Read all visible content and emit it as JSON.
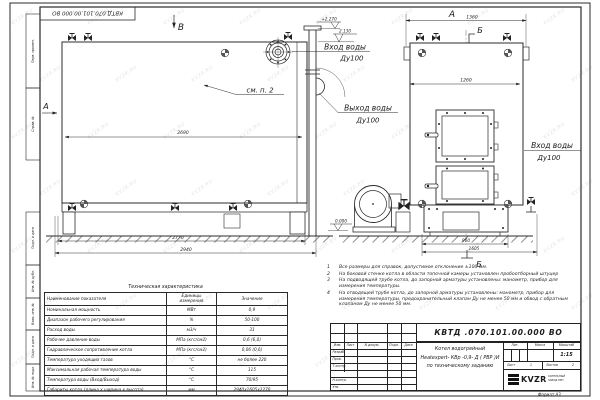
{
  "meta": {
    "corner_number": "КВТД.070.101.00.000 ВО",
    "format": "Формат  А3",
    "watermark": "KVZR.RU"
  },
  "view_labels": {
    "v_b": "В",
    "v_a_left": "А",
    "v_a_top": "А",
    "sec_b_top": "Б",
    "sec_b_bottom": "Б"
  },
  "dims": {
    "d1360": "1360",
    "d1260": "1260",
    "d2690": "2690",
    "d2770": "2770",
    "d2940": "2940",
    "d960": "960",
    "d1605": "1605"
  },
  "elev": {
    "top": "+2.270",
    "mid": "2.130",
    "zero": "0.000"
  },
  "labels": {
    "see_note": "см. п. 2",
    "inlet_top_line1": "Вход воды",
    "inlet_top_line2": "Ду100",
    "outlet_line1": "Выход воды",
    "outlet_line2": "Ду100",
    "inlet_right_line1": "Вход воды",
    "inlet_right_line2": "Ду100"
  },
  "margin_stamps": [
    "Перв. примен.",
    "Справ. №",
    "Подп. и дата",
    "Инв. № дубл.",
    "Взам. инв. №",
    "Подп. и дата",
    "Инв. № подл."
  ],
  "tech_table": {
    "title": "Техническая характеристика",
    "headers": [
      "Наименование показателя",
      "Единицы измерения",
      "Значение"
    ],
    "rows": [
      [
        "Номинальная мощность",
        "МВт",
        "0,9"
      ],
      [
        "Диапазон рабочего регулирования",
        "%",
        "50-100"
      ],
      [
        "Расход воды",
        "м3/ч",
        "31"
      ],
      [
        "Рабочее давление воды",
        "МПа (кгс/см2)",
        "0,6 (6,0)"
      ],
      [
        "Гидравлическое сопротивление котла",
        "МПа (кгс/см2)",
        "0,06 (0,6)"
      ],
      [
        "Температура уходящих газов",
        "°С",
        "не более 220"
      ],
      [
        "Максимальная рабочая температура воды",
        "°С",
        "115"
      ],
      [
        "Температура воды (Вход/Выход)",
        "°С",
        "70/95"
      ],
      [
        "Габариты котла (длина х ширина х высота)",
        "мм",
        "2940х1605х2270"
      ]
    ]
  },
  "notes": [
    {
      "num": "1",
      "text": "Все размеры для справок, допустимое отклонение ±100 мм."
    },
    {
      "num": "2",
      "text": "На боковой стенке котла в области топочной камеры установлен пробоотборный штуцер"
    },
    {
      "num": "3",
      "text": "На подводящей трубе котла, до запорной арматуры установлены: манометр, прибор для измерения температуры."
    },
    {
      "num": "4",
      "text": "На отводящей трубе котла, до запорной арматуры установлены: манометр, прибор для измерения температуры, предохранительный клапан Ду не менее 50 мм и обвод с обратным клапаном Ду не менее 50 мм."
    }
  ],
  "title_block": {
    "doc_number": "КВТД .070.101.00.000  ВО",
    "header_cells": [
      "Изм.",
      "Лист",
      "N докум.",
      "Подп.",
      "Дата"
    ],
    "roles": [
      "Разраб.",
      "Пров.",
      "Т.контр.",
      "Н.контр.",
      "Утв."
    ],
    "product_lines": [
      "Котел водогрейный",
      "Heatexpert- КВр -0,9- Д ( РВР )И",
      "по техническому заданию"
    ],
    "lit_label": "Лит.",
    "mass_label": "Масса",
    "scale_label": "Масштаб",
    "scale_value": "1:15",
    "sheet_label": "Лист",
    "sheet_value": "1",
    "sheets_label": "Листов",
    "sheets_value": "2",
    "logo_text": "KVZR",
    "logo_sub_line1": "КОТЕЛЬНЫЙ",
    "logo_sub_line2": "ЗАВОД РЭП"
  }
}
